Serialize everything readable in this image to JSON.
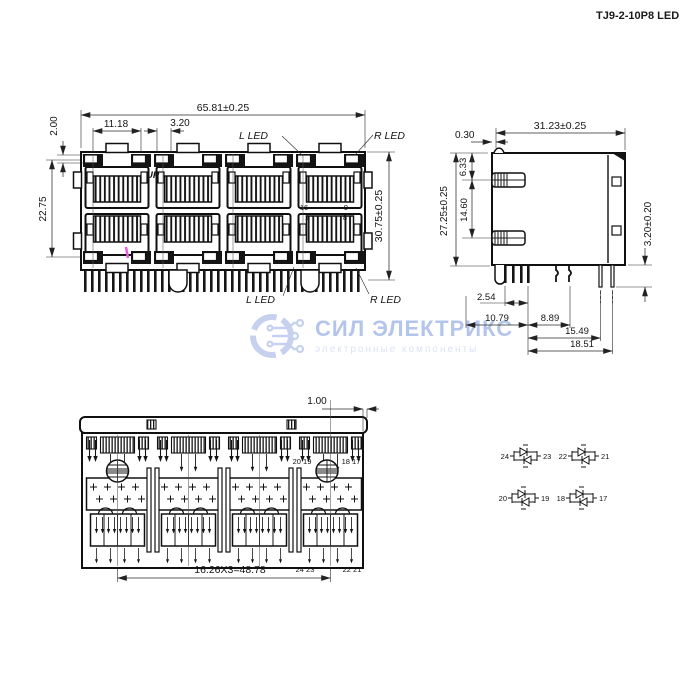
{
  "title": "TJ9-2-10P8 LED",
  "watermark": {
    "name": "СИЛ ЭЛЕКТРИКС",
    "subtitle": "электронные компоненты",
    "name_color": "#b3c5eb",
    "subtitle_color": "#dce3f4"
  },
  "front_view": {
    "dim_overall_width": "65.81±0.25",
    "dim_led_spacing": "11.18",
    "dim_led_width": "3.20",
    "dim_led_height": "2.00",
    "dim_row_spacing": "22.75",
    "dim_overall_height": "30.75±0.25",
    "label_l_led_top": "L LED",
    "label_r_led_top": "R LED",
    "label_l_led_bottom": "L LED",
    "label_r_led_bottom": "R LED",
    "label_up": "UP",
    "pin_16": "16",
    "pin_9": "9",
    "pin_1": "1",
    "pin_8": "8"
  },
  "side_view": {
    "dim_depth": "31.23±0.25",
    "dim_front_lip": "0.30",
    "dim_latch_top": "6.33",
    "dim_height": "27.25±0.25",
    "dim_latch_spacing": "14.60",
    "dim_pin_length": "3.20±0.20",
    "dim_pin_pitch": "2.54",
    "dim_pin_row_a": "10.79",
    "dim_pin_row_b": "8.89",
    "dim_pin_row_c": "15.49",
    "dim_pin_row_d": "18.51"
  },
  "bottom_view": {
    "dim_edge_offset": "1.00",
    "dim_port_pitch": "16.26X3=48.78",
    "label_pins_20_19": "20 19",
    "label_pins_18_17": "18 17",
    "label_pins_24_23": "24 23",
    "label_pins_22_21": "22 21"
  },
  "led_circuits": [
    {
      "left_pin": "24",
      "right_pin": "23"
    },
    {
      "left_pin": "22",
      "right_pin": "21"
    },
    {
      "left_pin": "20",
      "right_pin": "19"
    },
    {
      "left_pin": "18",
      "right_pin": "17"
    }
  ]
}
